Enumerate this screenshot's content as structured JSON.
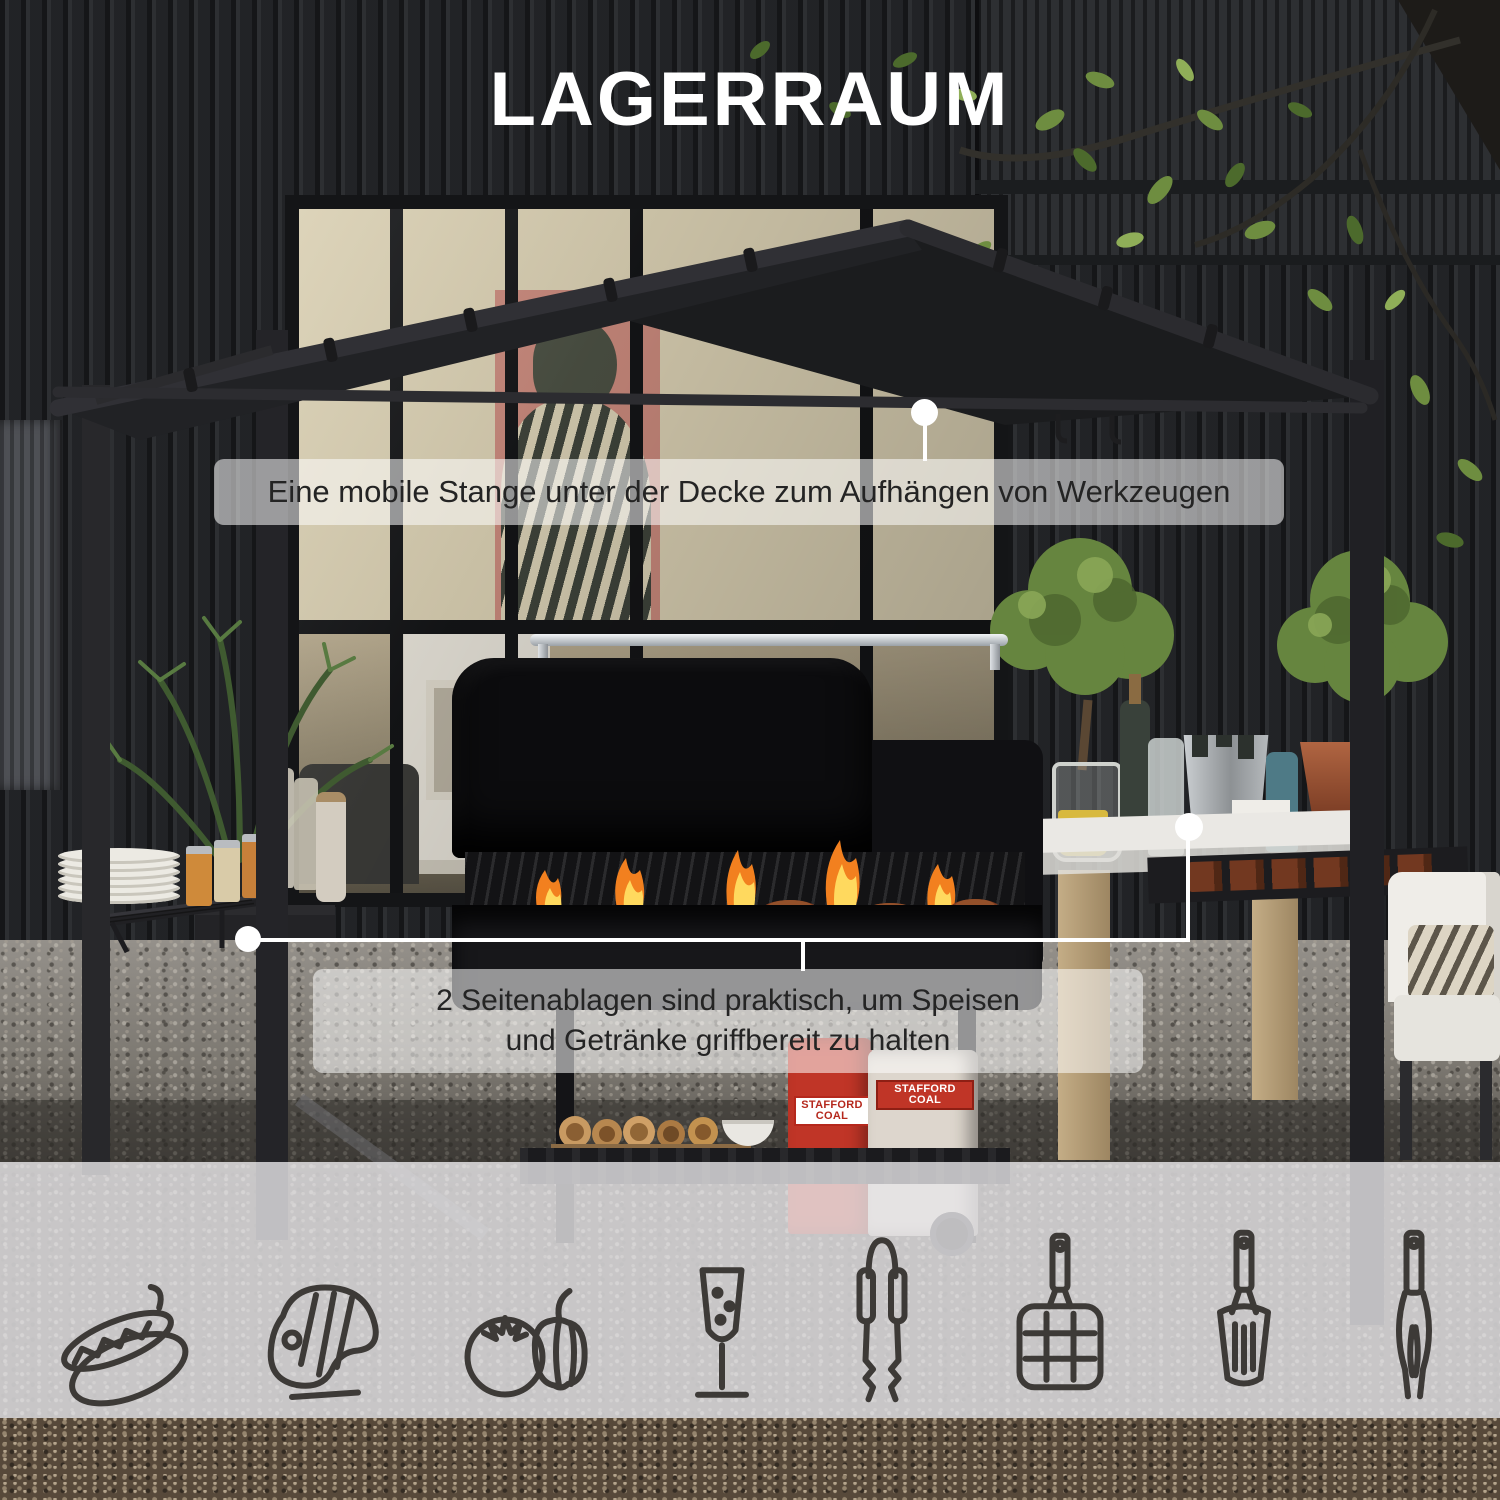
{
  "title": "LAGERRAUM",
  "callout1": {
    "text": "Eine mobile Stange unter der Decke zum Aufhängen von Werkzeugen"
  },
  "callout2": {
    "line1": "2 Seitenablagen sind praktisch, um Speisen",
    "line2": "und Getränke griffbereit zu halten"
  },
  "icons": [
    {
      "name": "hotdog-icon"
    },
    {
      "name": "steak-icon"
    },
    {
      "name": "vegetables-icon"
    },
    {
      "name": "champagne-glass-icon"
    },
    {
      "name": "tongs-icon"
    },
    {
      "name": "grill-basket-icon"
    },
    {
      "name": "spatula-icon"
    },
    {
      "name": "bbq-fork-icon"
    }
  ],
  "photo": {
    "coal_bag_text": "STAFFORD COAL"
  },
  "colors": {
    "band_background": "rgba(253,253,254,0.55)",
    "annotation_text": "#242424",
    "title_text": "#ffffff",
    "callout_line": "#ffffff",
    "canopy_fabric": "#1b1c1e",
    "flame_orange": "#f59b2c",
    "flame_yellow": "#ffd95e"
  }
}
